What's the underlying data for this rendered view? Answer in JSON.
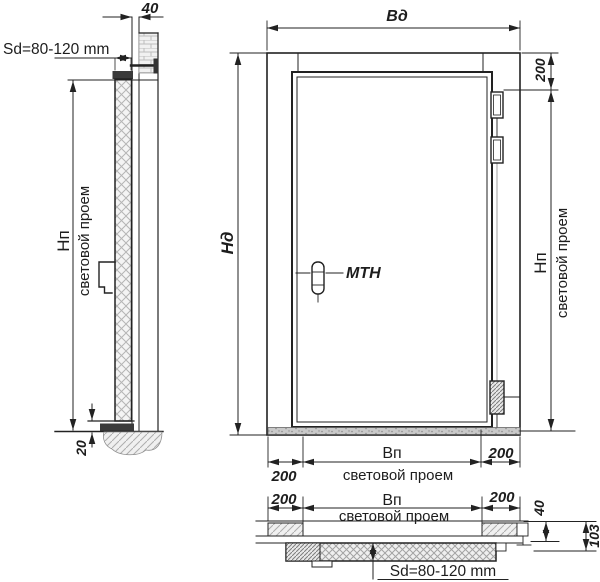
{
  "drawing_title": "Door installation drawing (three views)",
  "side_view": {
    "wall_offset": "40",
    "leaf_thickness": "Sd=80-120 mm",
    "opening_height_label": "Hп",
    "opening_height_sub": "световой проем",
    "threshold_gap": "20"
  },
  "front_view": {
    "door_width": "Вд",
    "door_height": "Нд",
    "hinge_offset": "200",
    "opening_height_label": "Нп",
    "opening_height_sub": "световой проем",
    "handle_label": "МТН",
    "left_margin": "200",
    "opening_width_label": "Вп",
    "opening_width_sub": "световой проем",
    "right_margin": "200"
  },
  "plan_view": {
    "left_margin": "200",
    "opening_width_label": "Вп",
    "opening_width_sub": "световой проем",
    "right_margin": "200",
    "frame_depth": "40",
    "total_depth": "103",
    "leaf_thickness": "Sd=80-120 mm"
  },
  "colors": {
    "line": "#222222",
    "hatch": "#b5b5b5",
    "threshold_fill": "#c9c9c9",
    "dark_fill": "#3a3a3a"
  }
}
